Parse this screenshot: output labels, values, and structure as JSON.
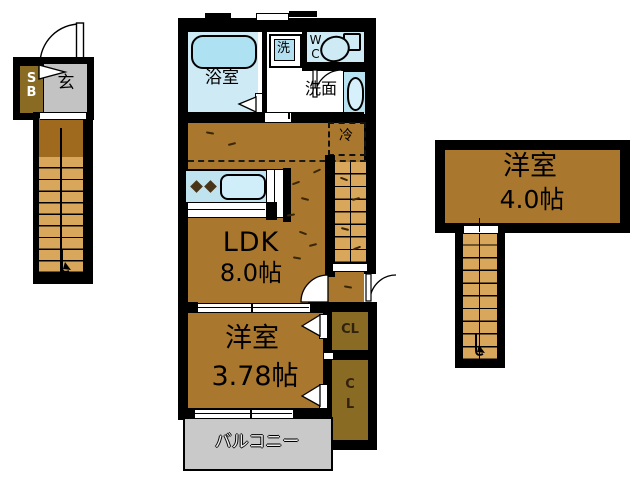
{
  "title": "apartment-floor-plan",
  "floor1": {
    "shoe_box": "S\nB",
    "entrance": "玄"
  },
  "floor2": {
    "bathroom": "浴室",
    "washer": "洗",
    "toilet": "W\nC",
    "washbasin": "洗面",
    "refrigerator": "冷",
    "ldk_name": "LDK",
    "ldk_size": "8.0帖",
    "bedroom_name": "洋室",
    "bedroom_size": "3.78帖",
    "closet_upper": "CL",
    "closet_lower": "C\nL",
    "balcony": "バルコニー"
  },
  "floor3": {
    "bedroom_name": "洋室",
    "bedroom_size": "4.0帖"
  },
  "colors": {
    "wall": "#000000",
    "floor_wood": "#a9772e",
    "stair_tread": "#d8a75c",
    "stair_landing": "#a06a1e",
    "storage_brown": "#8a6b24",
    "entry_gray": "#c3c3c3",
    "balcony_gray": "#c9c9c9",
    "water_blue": "#cdeaf5",
    "bathtub_blue": "#aee2f2",
    "counter_blue": "#bfe4f0"
  }
}
